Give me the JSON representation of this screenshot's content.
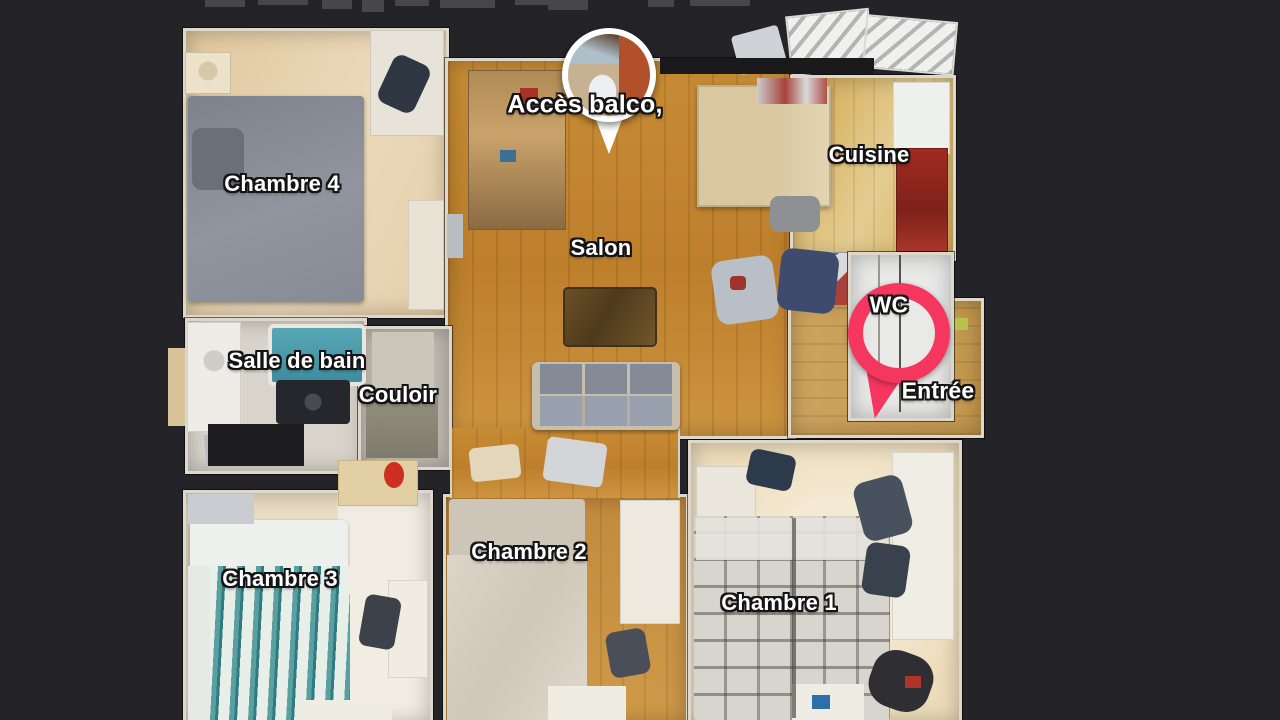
{
  "view": {
    "name": "3d-floorplan-top-view",
    "background_color": "#242428"
  },
  "rooms": {
    "chambre4": {
      "label": "Chambre 4"
    },
    "salon": {
      "label": "Salon"
    },
    "cuisine": {
      "label": "Cuisine"
    },
    "salle_de_bain": {
      "label": "Salle de bain"
    },
    "couloir": {
      "label": "Couloir"
    },
    "wc": {
      "label": "WC"
    },
    "entree": {
      "label": "Entrée"
    },
    "chambre3": {
      "label": "Chambre 3"
    },
    "chambre2": {
      "label": "Chambre 2"
    },
    "chambre1": {
      "label": "Chambre 1"
    }
  },
  "pins": {
    "balcony_photo_pin": {
      "label": "Accès balco,",
      "ring_color": "#ffffff"
    },
    "wc_location_pin": {
      "ring_color": "#f5365f"
    }
  }
}
